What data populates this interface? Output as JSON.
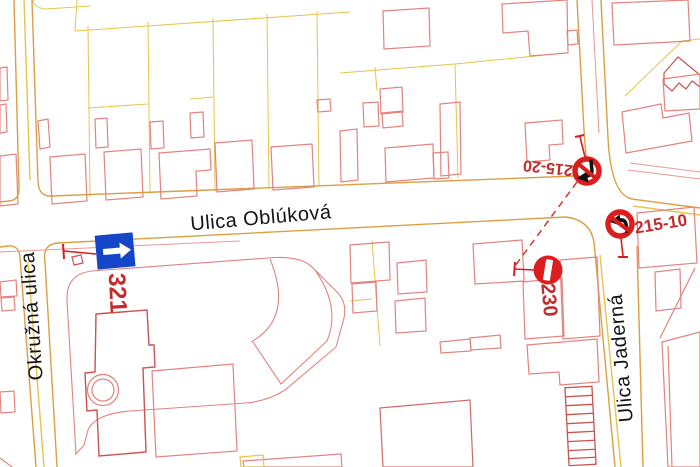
{
  "map": {
    "title": "traffic-signage-plan",
    "streets": [
      {
        "label": "Ulica Oblúková"
      },
      {
        "label": "Okružná ulica"
      },
      {
        "label": "Ulica Jaderná"
      }
    ],
    "signs": [
      {
        "code": "321",
        "type": "one-way-arrow-right",
        "shape": "blue-square-white-arrow"
      },
      {
        "code": "230",
        "type": "no-entry",
        "shape": "red-circle-white-bar"
      },
      {
        "code": "215-20",
        "type": "no-left-turn",
        "shape": "red-ring-black-arrow-slash"
      },
      {
        "code": "215-10",
        "type": "no-left-turn",
        "shape": "red-ring-black-arrow-slash"
      }
    ],
    "colors": {
      "background": "#FFFFFF",
      "road_line": "#DB9F43",
      "road_line_yellow": "#E5C44C",
      "road_line_pink": "#E59B94",
      "building_line": "#E2837E",
      "building_line_dark": "#C9534E",
      "sign_red": "#DC1D1D",
      "sign_blue": "#1646C8",
      "label_red": "#C42B2B",
      "street_text": "#141414"
    }
  }
}
